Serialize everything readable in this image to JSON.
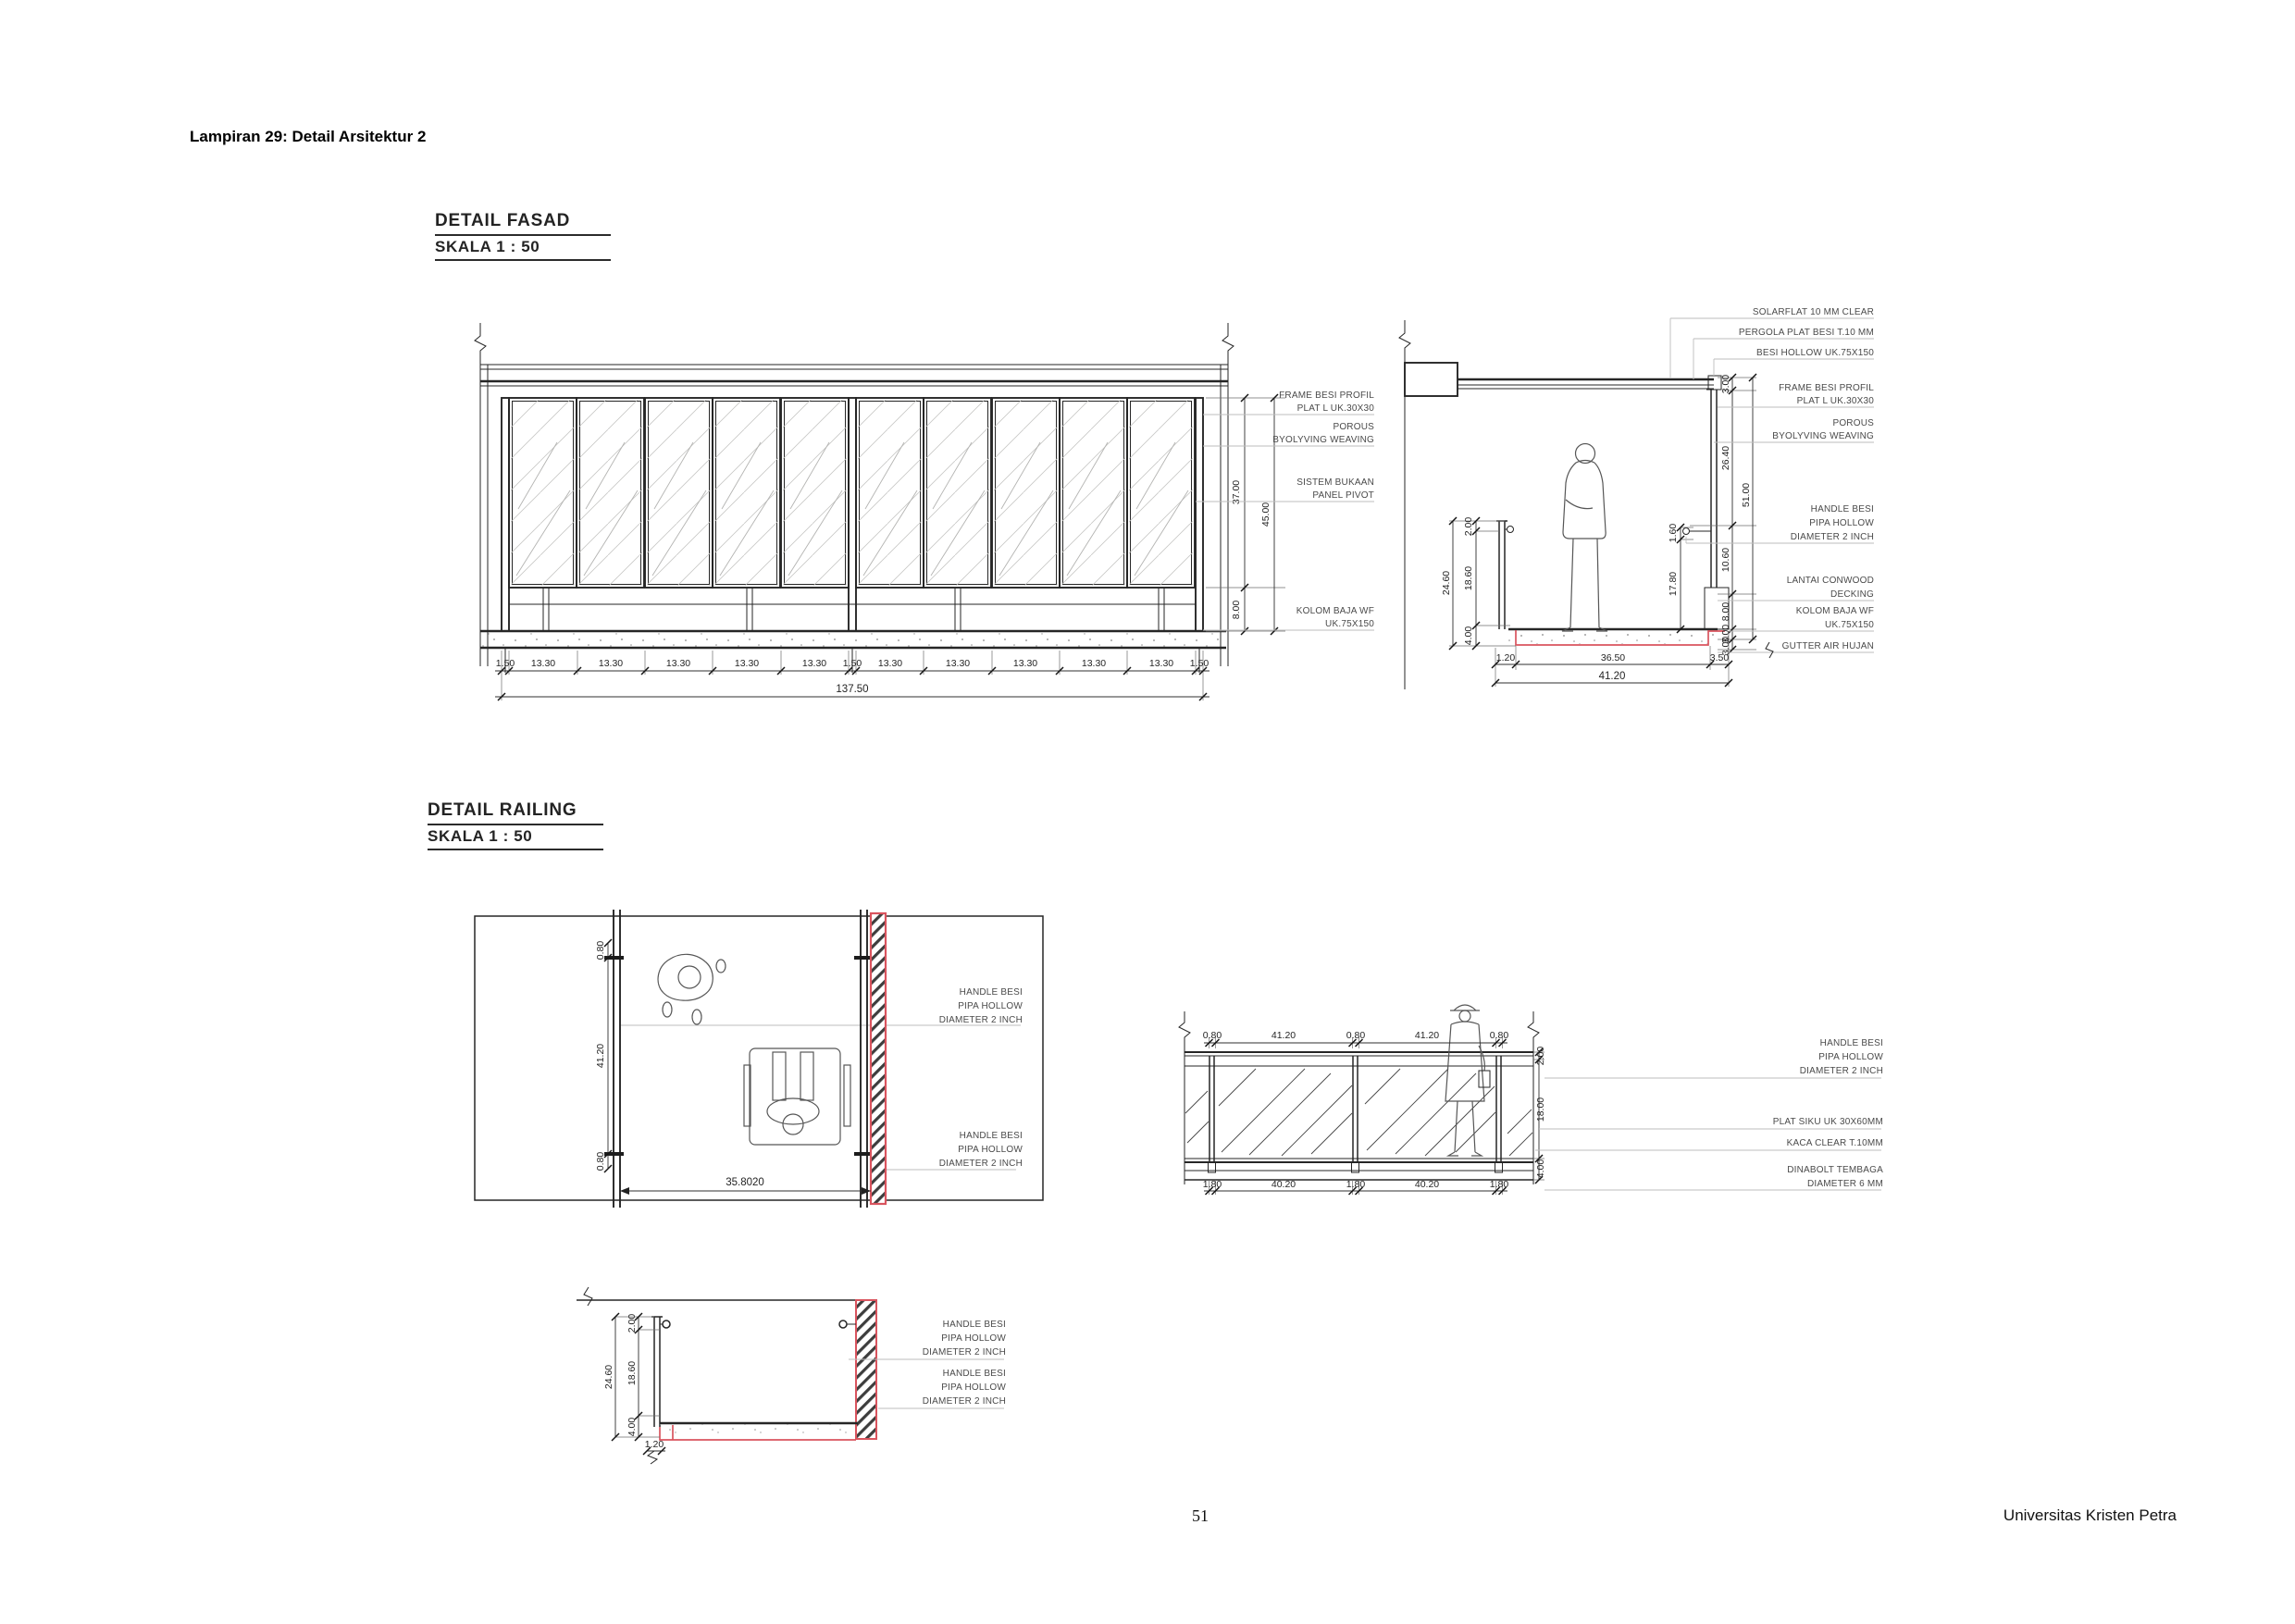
{
  "page": {
    "header": "Lampiran 29: Detail Arsitektur 2",
    "page_number": "51",
    "footer_right": "Universitas Kristen Petra"
  },
  "colors": {
    "accent_red": "#d9545e",
    "drawing_line": "#262626",
    "dim_text": "#242424",
    "leader_line": "#bdbdbd"
  },
  "detail_fasad": {
    "title": "DETAIL FASAD",
    "scale": "SKALA 1 : 50",
    "elevation": {
      "dims_bottom": [
        "1.50",
        "13.30",
        "13.30",
        "13.30",
        "13.30",
        "13.30",
        "1.50",
        "13.30",
        "13.30",
        "13.30",
        "13.30",
        "13.30",
        "1.50"
      ],
      "dim_total_width": "137.50",
      "dim_panel_height": "37.00",
      "dim_base_height": "8.00",
      "dim_total_height": "45.00",
      "annotations": [
        {
          "lines": [
            "FRAME BESI PROFIL",
            "PLAT L UK.30X30"
          ]
        },
        {
          "lines": [
            "POROUS",
            "BYOLYVING WEAVING"
          ]
        },
        {
          "lines": [
            "SISTEM BUKAAN",
            "PANEL PIVOT"
          ]
        },
        {
          "lines": [
            "KOLOM BAJA WF",
            "UK.75X150"
          ]
        }
      ]
    },
    "section": {
      "dims_left": {
        "handrail": "2.00",
        "rail_body": "18.60",
        "total": "24.60",
        "base": "4.00"
      },
      "dims_inner": {
        "handle_offset": "1.60",
        "handle_height": "17.80"
      },
      "dims_right": {
        "top_frame": "3.00",
        "screen_upper": "26.40",
        "screen_total": "51.00",
        "screen_lower": "10.60",
        "column": "8.00",
        "deck": "3.00",
        "gutter": "3.00"
      },
      "dims_bottom": {
        "edge": "1.20",
        "span": "36.50",
        "column": "3.50",
        "total": "41.20"
      },
      "annotations": [
        {
          "lines": [
            "SOLARFLAT 10 MM CLEAR"
          ]
        },
        {
          "lines": [
            "PERGOLA PLAT BESI T.10 MM"
          ]
        },
        {
          "lines": [
            "BESI HOLLOW UK.75X150"
          ]
        },
        {
          "lines": [
            "FRAME BESI PROFIL",
            "PLAT L UK.30X30"
          ]
        },
        {
          "lines": [
            "POROUS",
            "BYOLYVING WEAVING"
          ]
        },
        {
          "lines": [
            "HANDLE BESI",
            "PIPA HOLLOW",
            "DIAMETER 2 INCH"
          ]
        },
        {
          "lines": [
            "LANTAI CONWOOD",
            "DECKING"
          ]
        },
        {
          "lines": [
            "KOLOM BAJA WF",
            "UK.75X150"
          ]
        },
        {
          "lines": [
            "GUTTER AIR HUJAN"
          ]
        }
      ]
    }
  },
  "detail_railing": {
    "title": "DETAIL RAILING",
    "scale": "SKALA 1 : 50",
    "plan": {
      "dims": {
        "top_offset": "0.80",
        "clear_width": "41.20",
        "bottom_offset": "0.80",
        "opening": "35.8020"
      },
      "annotations": [
        {
          "lines": [
            "HANDLE BESI",
            "PIPA HOLLOW",
            "DIAMETER 2 INCH"
          ]
        },
        {
          "lines": [
            "HANDLE BESI",
            "PIPA HOLLOW",
            "DIAMETER 2 INCH"
          ]
        }
      ]
    },
    "elevation": {
      "dims_top": [
        "0.80",
        "41.20",
        "0.80",
        "41.20",
        "0.80"
      ],
      "dims_bottom": [
        "1.80",
        "40.20",
        "1.80",
        "40.20",
        "1.80"
      ],
      "dims_right": {
        "handrail": "2.00",
        "glass": "18.00",
        "base": "4.00"
      },
      "annotations": [
        {
          "lines": [
            "HANDLE BESI",
            "PIPA HOLLOW",
            "DIAMETER 2 INCH"
          ]
        },
        {
          "lines": [
            "PLAT SIKU UK 30X60MM"
          ]
        },
        {
          "lines": [
            "KACA CLEAR T.10MM"
          ]
        },
        {
          "lines": [
            "DINABOLT TEMBAGA",
            "DIAMETER 6 MM"
          ]
        }
      ]
    },
    "section": {
      "dims": {
        "handrail": "2.00",
        "rail_body": "18.60",
        "total": "24.60",
        "base": "4.00",
        "edge": "1.20"
      },
      "annotations": [
        {
          "lines": [
            "HANDLE BESI",
            "PIPA HOLLOW",
            "DIAMETER 2 INCH"
          ]
        },
        {
          "lines": [
            "HANDLE BESI",
            "PIPA HOLLOW",
            "DIAMETER 2 INCH"
          ]
        }
      ]
    }
  }
}
